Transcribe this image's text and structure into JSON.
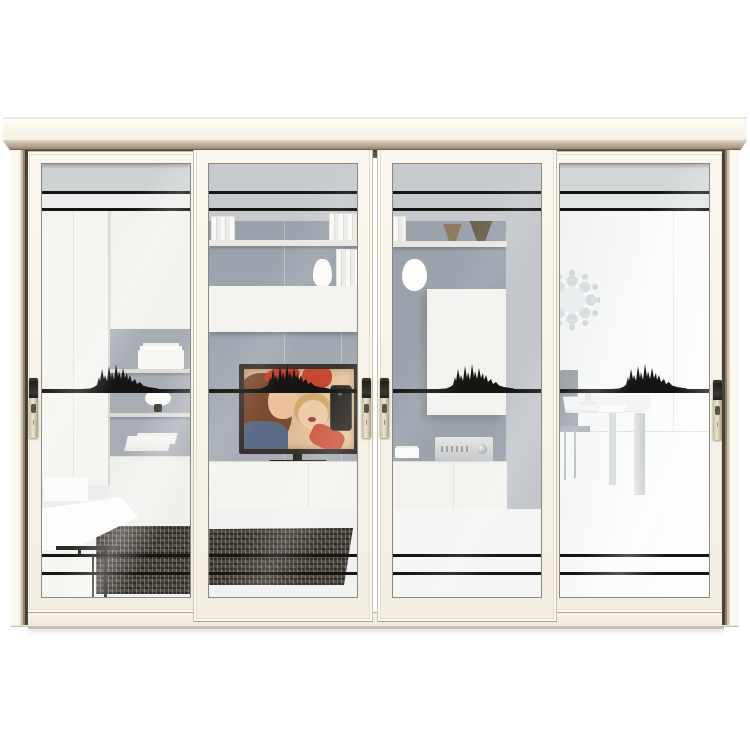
{
  "meta": {
    "image_type": "product photo",
    "subject": "White aluminium 4-panel sliding glass door with black decorative decal stripes and mountain-silhouette stickers; a modern living room is visible through the glass",
    "background_color": "#ffffff",
    "no_visible_text": true
  },
  "door": {
    "panel_count": 4,
    "frame_color": "#f7f3e9",
    "trim_color": "#b7a794",
    "track_color": "#4a4136",
    "glass_tint": "#eef0ef",
    "decals": {
      "color": "#151514",
      "top_line_count": 2,
      "bottom_line_count": 2,
      "mid_band": "thick line with mountain-skyline silhouette sticker on every panel"
    },
    "handles": {
      "count": 4,
      "style": "vertical recessed pull with dark cap",
      "body_color": "#d9cbb4",
      "cap_color": "#23201d"
    },
    "panels": [
      {
        "id": 1,
        "position": "far-left",
        "depth": "back track",
        "scene": "white wardrobe, upper cabinet, gray open shelving niche with towels and bowl lamp, white dining table with white chairs, dark textured rug"
      },
      {
        "id": 2,
        "position": "center-left",
        "depth": "front track",
        "scene": "gray media wall, floating shelf with books, white vase, floating cabinet, flat TV showing a woman and child taking a selfie with a phone, white lowboard, dark rug"
      },
      {
        "id": 3,
        "position": "center-right",
        "depth": "front track",
        "scene": "gray wall, shelf with two brown cone bowls, white cup, tall white cabinet, silver stereo amplifier on white sideboard, papers"
      },
      {
        "id": 4,
        "position": "far-right",
        "depth": "back track",
        "scene": "bright white dining area, white table with cake stand and papers, gray chair, dandelion-style wall decoration"
      }
    ]
  },
  "tv_picture": {
    "subjects": "woman with auburn hair, red headband and blue top; blond child holding dark phone for selfie",
    "frame_color": "#3a312a"
  },
  "palette": {
    "crown_molding": "#f3eee1",
    "bevel_dark": "#9a8b77",
    "wall_gray": "#99a1ab",
    "rug_dark": "#49433b",
    "decal_black": "#151514",
    "handle_champagne": "#d9cbb4"
  }
}
